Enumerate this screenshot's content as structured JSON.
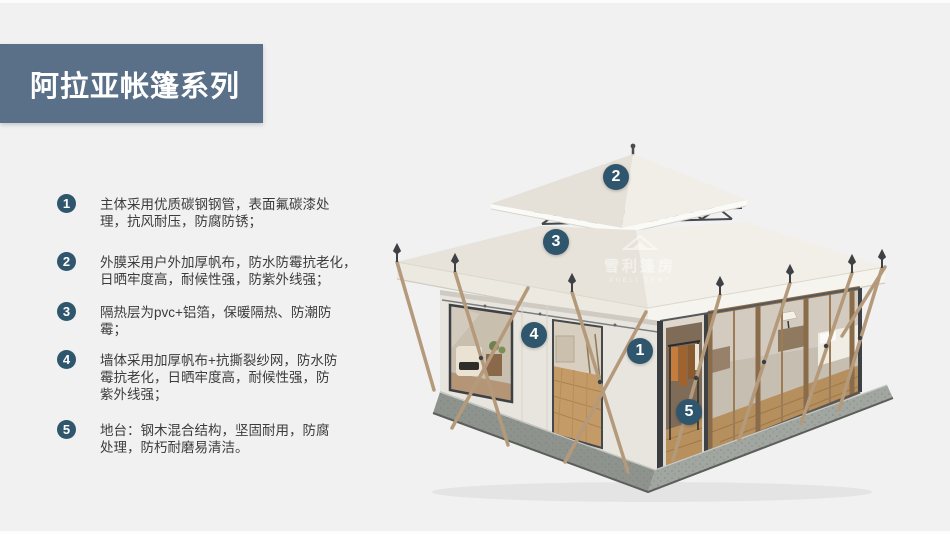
{
  "header": {
    "title": "阿拉亚帐篷系列"
  },
  "features": [
    {
      "num": "1",
      "text": "主体采用优质碳钢钢管，表面氟碳漆处\n理，抗风耐压，防腐防锈；"
    },
    {
      "num": "2",
      "text": "外膜采用户外加厚帆布，防水防霉抗老化，\n日晒牢度高，耐候性强，防紫外线强；"
    },
    {
      "num": "3",
      "text": "隔热层为pvc+铝箔，保暖隔热、防潮防\n霉；"
    },
    {
      "num": "4",
      "text": "墙体采用加厚帆布+抗撕裂纱网，防水防\n霉抗老化，日晒牢度高，耐候性强，防\n紫外线强；"
    },
    {
      "num": "5",
      "text": "地台：钢木混合结构，坚固耐用，防腐\n处理，防朽耐磨易清洁。"
    }
  ],
  "tent": {
    "markers": [
      "1",
      "2",
      "3",
      "4",
      "5"
    ],
    "watermark_cn": "雪利篷房",
    "watermark_en": "XUELI TENT"
  },
  "colors": {
    "banner": "#5a7088",
    "bullet": "#30566d",
    "page_bg": "#f1f1f2"
  }
}
